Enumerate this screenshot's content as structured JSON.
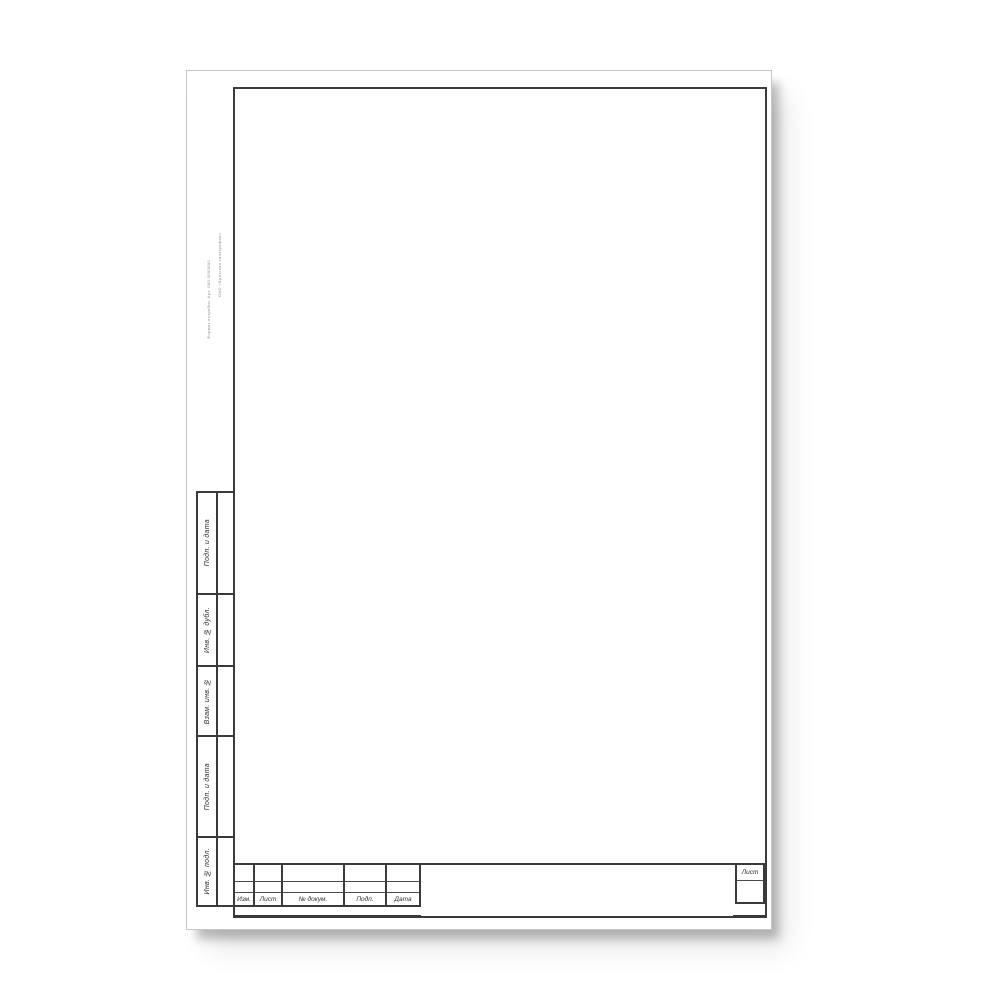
{
  "side_column": {
    "boxes": [
      {
        "label": "Подп. и дата"
      },
      {
        "label": "Инв. № дубл."
      },
      {
        "label": "Взам. инв. №"
      },
      {
        "label": "Подп. и дата"
      },
      {
        "label": "Инв. № подл."
      }
    ]
  },
  "title_block": {
    "headers": [
      "Изм.",
      "Лист",
      "№ докум.",
      "Подп.",
      "Дата"
    ],
    "sheet_label": "Лист"
  },
  "edge_imprint": {
    "line1": "ОАО «Братская типография»",
    "line2": "Формат потребит.  Арт. 000 0000000"
  },
  "colors": {
    "paper": "#ffffff",
    "line": "#3a3a3a",
    "shadow": "#9a9a9a"
  }
}
